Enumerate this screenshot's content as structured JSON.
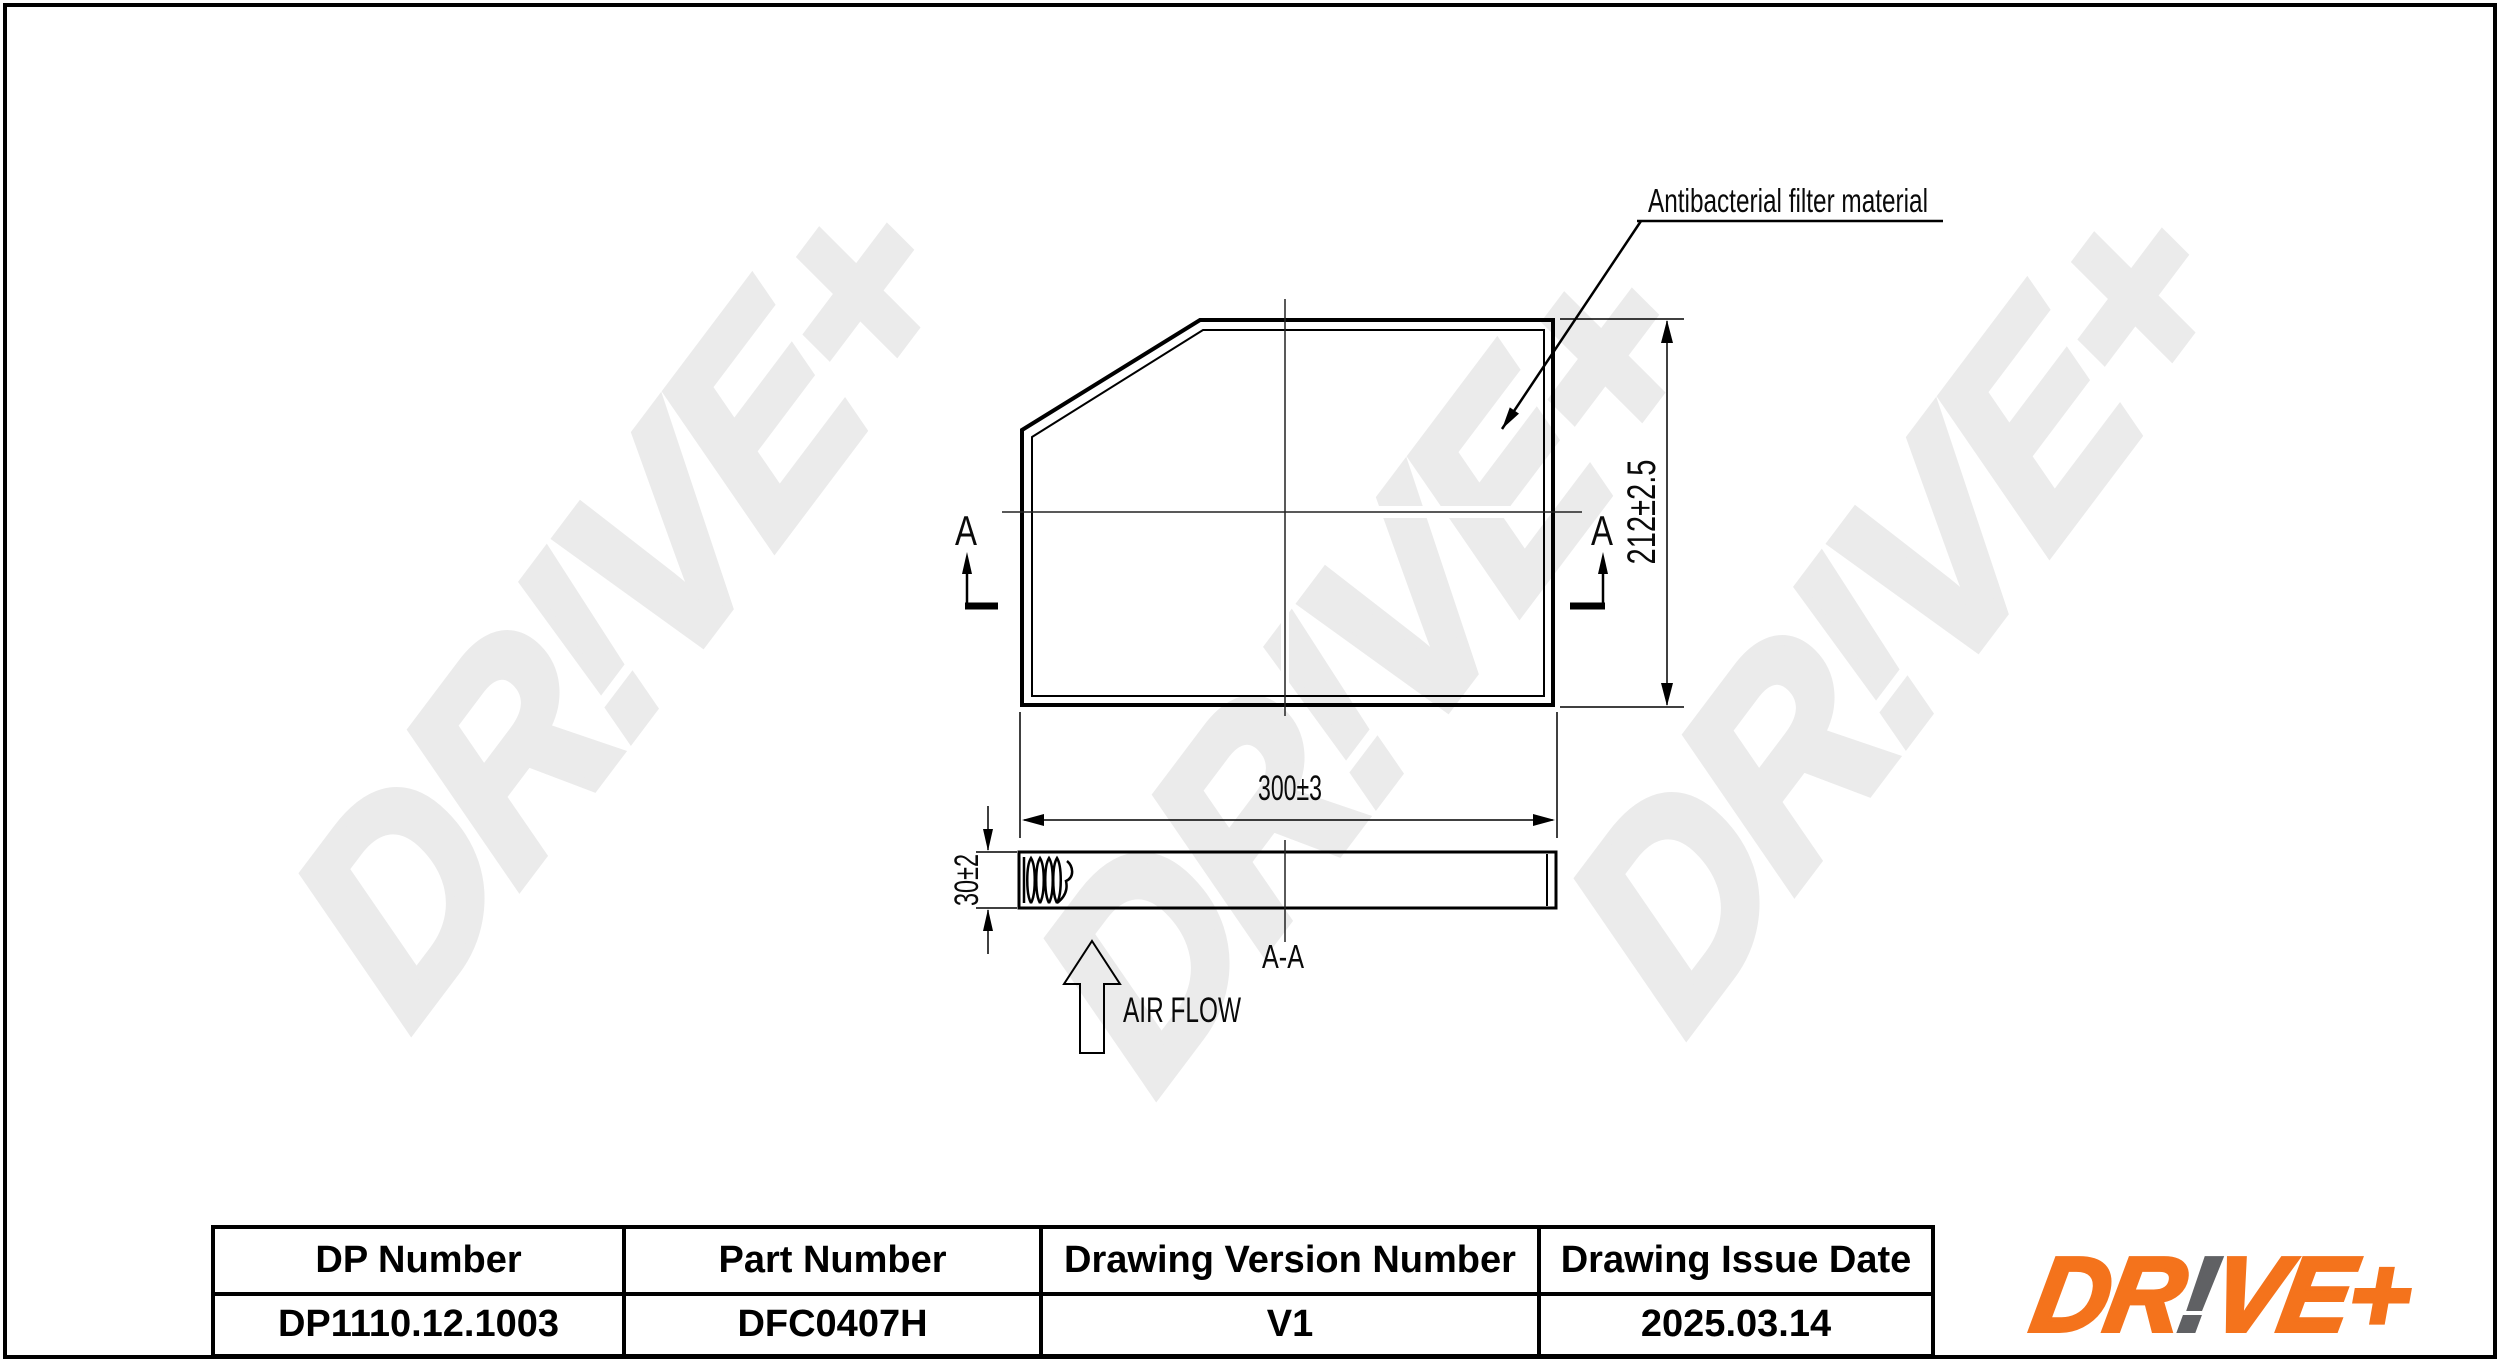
{
  "watermark": {
    "text": "DR!VE+",
    "color": "#ebebeb"
  },
  "drawing": {
    "callout_label": "Antibacterial filter material",
    "height_dim": "212±2.5",
    "width_dim": "300±3",
    "thickness_dim": "30±2",
    "section_marker": "A",
    "section_title": "A-A",
    "airflow_label": "AIR FLOW"
  },
  "table": {
    "columns": [
      {
        "header": "DP Number",
        "value": "DP1110.12.1003"
      },
      {
        "header": "Part Number",
        "value": "DFC0407H"
      },
      {
        "header": "Drawing Version Number",
        "value": "V1"
      },
      {
        "header": "Drawing Issue Date",
        "value": "2025.03.14"
      }
    ]
  },
  "logo": {
    "part1": "DR",
    "bang": "!",
    "part2": "VE+",
    "orange": "#f4731c",
    "gray": "#606164"
  }
}
